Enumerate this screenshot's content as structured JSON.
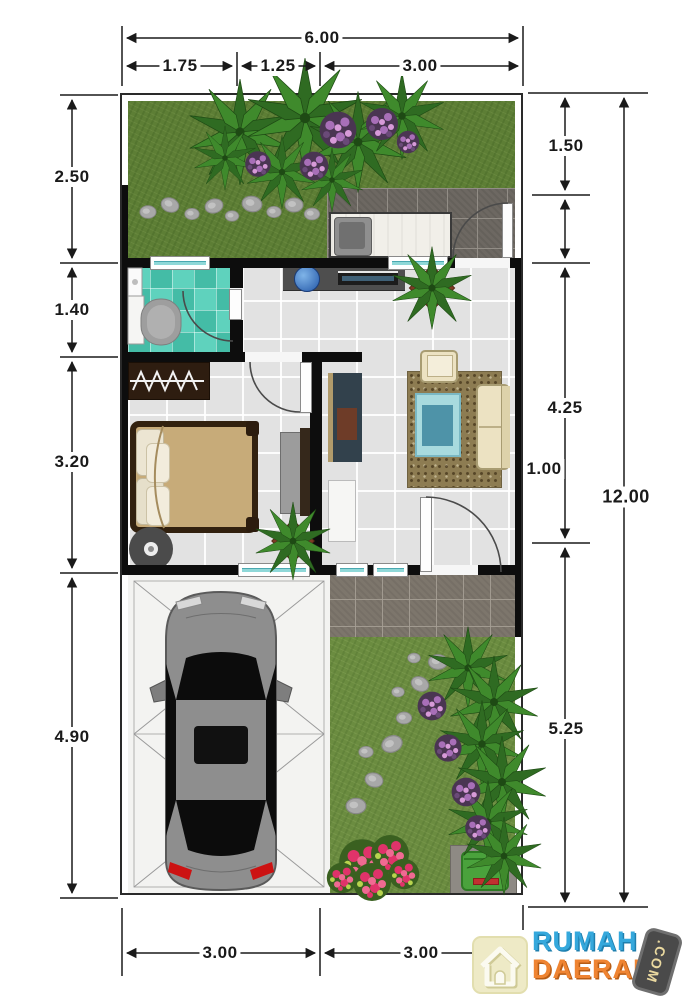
{
  "dimensions": {
    "top": {
      "overall": "6.00",
      "seg1": "1.75",
      "seg2": "1.25",
      "seg3": "3.00"
    },
    "left": {
      "seg1": "2.50",
      "seg2": "1.40",
      "seg3": "3.20",
      "seg4": "4.90"
    },
    "right": {
      "overall": "12.00",
      "seg1": "1.50",
      "seg2": "4.25",
      "seg3": "1.00",
      "seg4": "5.25"
    },
    "bottom": {
      "seg1": "3.00",
      "seg2": "3.00"
    }
  },
  "watermark": {
    "brand_line1": "RUMAH",
    "brand_line2": "DAERAH",
    "brand_suffix": ".COM"
  },
  "colors": {
    "wall": "#0d0d0d",
    "grass_back": "#5d7e35",
    "grass_front": "#6b8c40",
    "bathroom_tile": "#4cc4ad",
    "window_glass": "#8fd8d8",
    "dimension_text": "#1a1a1a",
    "brand_blue": "#35a8dc",
    "brand_orange": "#ef8432"
  }
}
